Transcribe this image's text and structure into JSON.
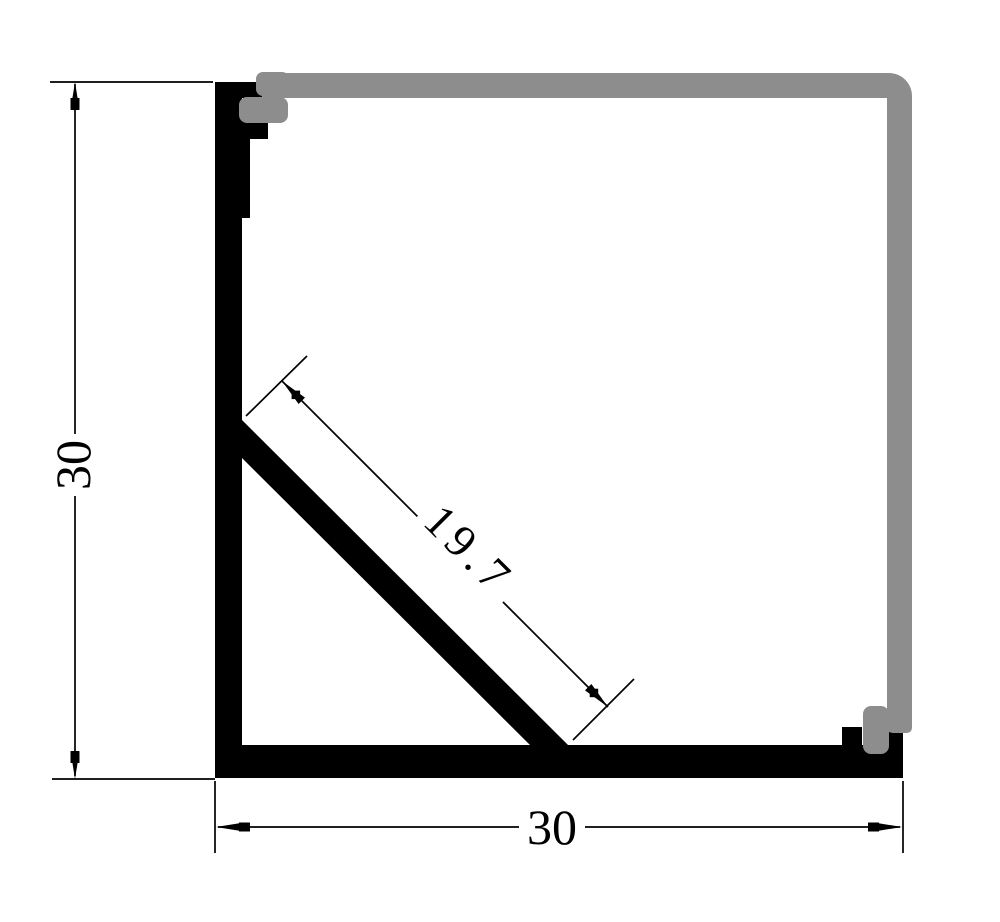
{
  "drawing": {
    "colors": {
      "extrusion": "#000000",
      "cover": "#8d8d8d",
      "background": "#ffffff",
      "annotation": "#000000"
    },
    "dimensions": {
      "height": {
        "value": "30"
      },
      "width": {
        "value": "30"
      },
      "diagonal": {
        "value": "19.7"
      }
    }
  }
}
